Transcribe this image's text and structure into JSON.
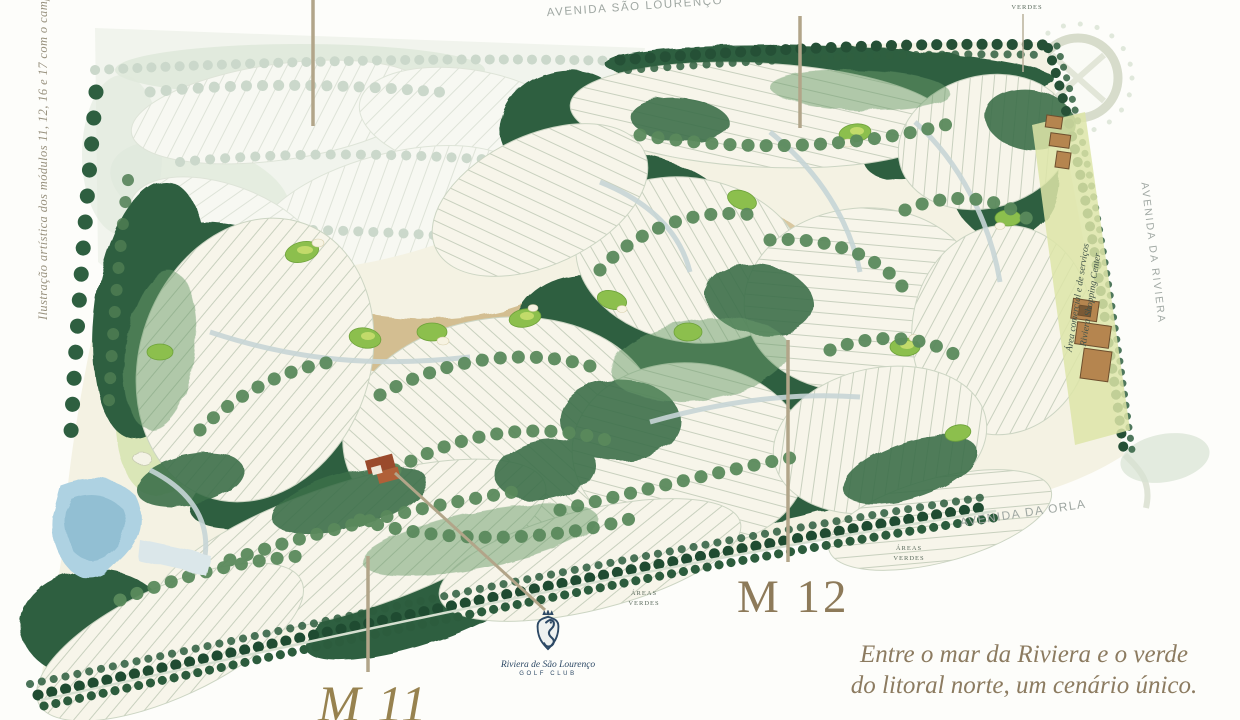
{
  "illustration_caption": "Ilustração artística dos módulos 11, 12, 16 e 17 com o campo de golf",
  "roads": {
    "top": "AVENIDA SÃO LOURENÇO",
    "right": "AVENIDA DA RIVIERA",
    "shore": "AVENIDA DA ORLA"
  },
  "green_areas_label": {
    "line1": "ÁREAS",
    "line2": "VERDES"
  },
  "shopping": {
    "line1": "Área comercial e de serviços",
    "line2": "Riviera Shopping Center"
  },
  "modules": {
    "m12": "M 12",
    "m11": "M 11"
  },
  "golf_club": {
    "name": "Riviera de São Lourenço",
    "subtitle": "GOLF CLUB"
  },
  "tagline": {
    "line1": "Entre o mar da Riviera e o verde",
    "line2": "do litoral norte, um cenário único."
  },
  "colors": {
    "forest_green": "#2c5c3d",
    "fairway_tan": "#cdb583",
    "lake_blue": "#a8cfe0",
    "module_label_brown": "#8d7a59",
    "brand_navy": "#2d4965",
    "road_label_gray": "#9fa7a2"
  }
}
